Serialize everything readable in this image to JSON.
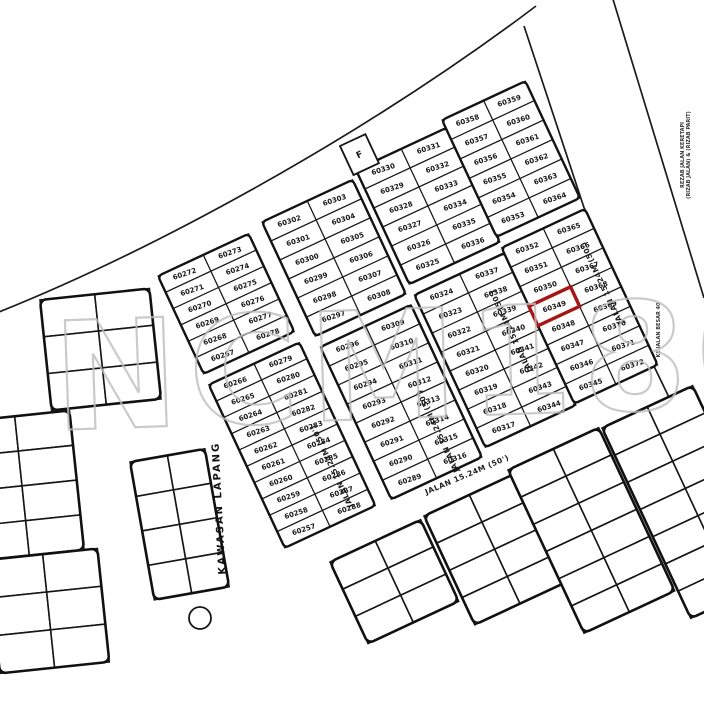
{
  "watermark": {
    "text": "NCM180",
    "color": "#bdbdbd"
  },
  "highlight": {
    "lot": "60349",
    "color": "#a61616"
  },
  "labels": {
    "open_space": "KAWASAN LAPANG",
    "street_50ft": "JALAN 15.24M (50')",
    "bottom_street": "JALAN 15.24M (50')",
    "substation_box": "F",
    "edge_note_top": "REZAB JALAN KERETAPI",
    "edge_note_top2": "(RIZAB JALAN) & (RIZAB PARIT)",
    "edge_note_bottom": "KE JALAN BESAR 40"
  },
  "strips": [
    {
      "id": "strip-1",
      "left": [
        "60272",
        "60271",
        "60270",
        "60269",
        "60268",
        "60267",
        "60266",
        "60265",
        "60264",
        "60263",
        "60262",
        "60261",
        "60260",
        "60259",
        "60258",
        "60257"
      ],
      "right": [
        "60273",
        "60274",
        "60275",
        "60276",
        "60277",
        "60278",
        "60279",
        "60280",
        "60281",
        "60282",
        "60283",
        "60284",
        "60285",
        "60286",
        "60287",
        "60288"
      ]
    },
    {
      "id": "strip-2",
      "left": [
        "60302",
        "60301",
        "60300",
        "60299",
        "60298",
        "60297",
        "60296",
        "60295",
        "60294",
        "60293",
        "60292",
        "60291",
        "60290",
        "60289"
      ],
      "right": [
        "60303",
        "60304",
        "60305",
        "60306",
        "60307",
        "60308",
        "60309",
        "60310",
        "60311",
        "60312",
        "60313",
        "60314",
        "60315",
        "60316"
      ]
    },
    {
      "id": "strip-3",
      "left": [
        "60330",
        "60329",
        "60328",
        "60327",
        "60326",
        "60325",
        "60324",
        "60323",
        "60322",
        "60321",
        "60320",
        "60319",
        "60318",
        "60317"
      ],
      "right": [
        "60331",
        "60332",
        "60333",
        "60334",
        "60335",
        "60336",
        "60337",
        "60338",
        "60339",
        "60340",
        "60341",
        "60342",
        "60343",
        "60344"
      ]
    },
    {
      "id": "strip-4",
      "left": [
        "60358",
        "60357",
        "60356",
        "60355",
        "60354",
        "60353",
        "60352",
        "60351",
        "60350",
        "60349",
        "60348",
        "60347",
        "60346",
        "60345"
      ],
      "right": [
        "60359",
        "60360",
        "60361",
        "60362",
        "60363",
        "60364",
        "60365",
        "60366",
        "60367",
        "60368",
        "60369",
        "60370",
        "60371",
        "60372"
      ]
    }
  ]
}
